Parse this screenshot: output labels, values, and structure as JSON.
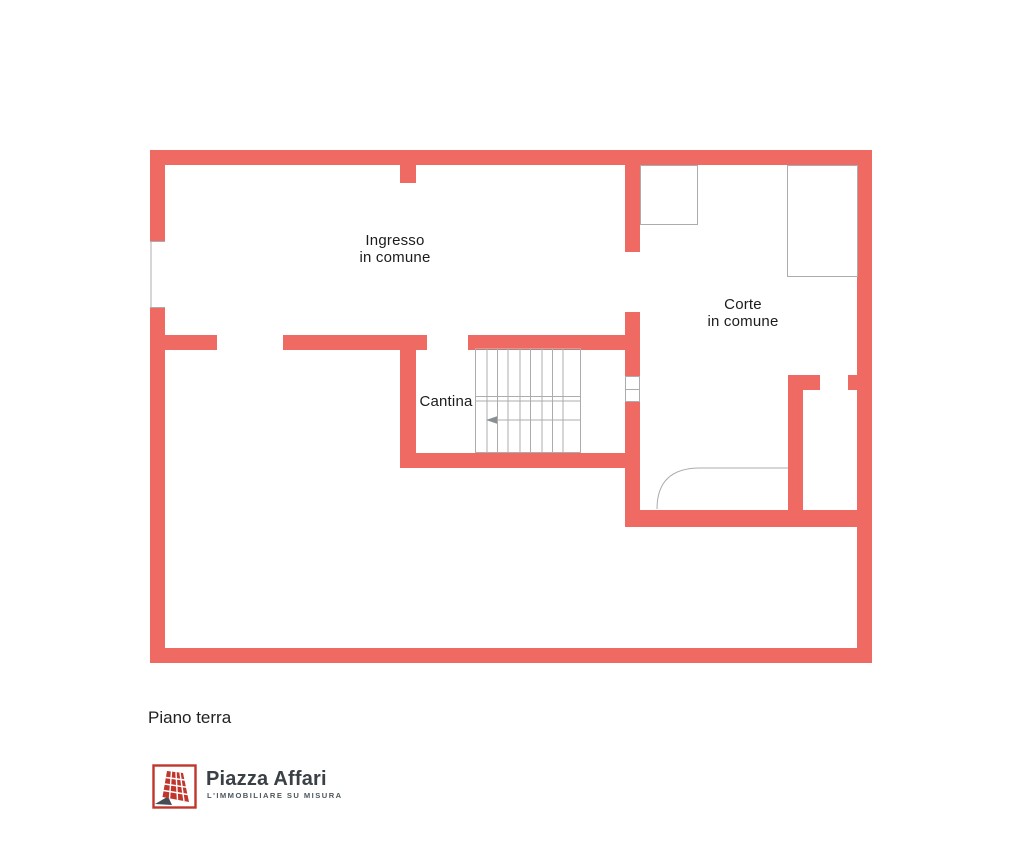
{
  "plan": {
    "floor_label": "Piano terra",
    "rooms": [
      {
        "id": "ingresso",
        "line1": "Ingresso",
        "line2": "in comune"
      },
      {
        "id": "corte",
        "line1": "Corte",
        "line2": "in comune"
      },
      {
        "id": "cantina",
        "line1": "Cantina",
        "line2": ""
      }
    ],
    "features": [
      "staircase-with-direction-arrow",
      "door-swing-arc",
      "wall-openings",
      "projection-outlines"
    ],
    "colors": {
      "wall": "#f06a64",
      "thin_line": "#a9adb0",
      "label_text": "#1c1c1c"
    }
  },
  "footer": {
    "brand_name": "Piazza Affari",
    "brand_tagline": "L'IMMOBILIARE SU MISURA",
    "brand_color": "#c0362c",
    "brand_text_color": "#3a4045",
    "tagline_color": "#4d565c"
  },
  "icons": {
    "brand_logo": "building-grid-icon"
  }
}
